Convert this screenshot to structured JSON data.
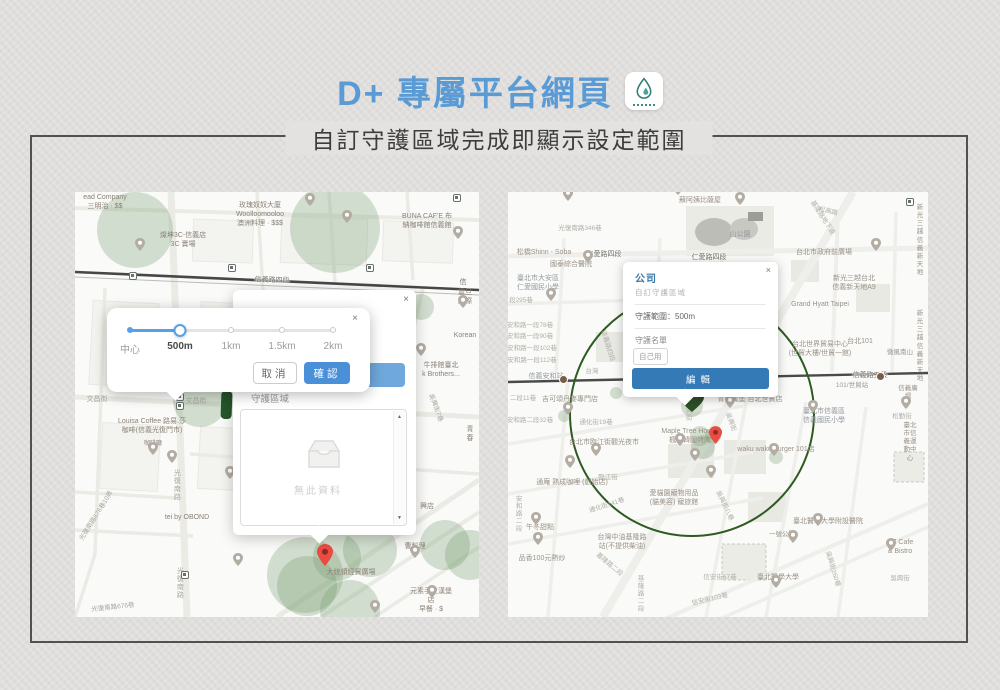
{
  "header": {
    "title": "D+ 專屬平台網頁",
    "subtitle": "自訂守護區域完成即顯示設定範圍"
  },
  "colors": {
    "title_blue": "#5b9bd5",
    "confirm_blue": "#4a90d9",
    "edit_blue": "#337ab7",
    "range_circle_green": "#2d5c20",
    "marker_green": "#26562b",
    "pin_red": "#ea4b42"
  },
  "left_map": {
    "slider_popup": {
      "close": "×",
      "ticks": [
        {
          "label": "中心",
          "x": 23
        },
        {
          "label": "500m",
          "x": 73,
          "selected": true
        },
        {
          "label": "1km",
          "x": 124
        },
        {
          "label": "1.5km",
          "x": 175
        },
        {
          "label": "2km",
          "x": 226
        }
      ],
      "cancel": "取消",
      "confirm": "確認"
    },
    "list_popup": {
      "close": "×",
      "section_label": "守護區域",
      "empty_text": "無此資料",
      "scroll_up": "▲",
      "scroll_down": "▼"
    },
    "labels": [
      {
        "t": "ead Company\n三明治 · $$",
        "x": 30,
        "y": 2,
        "c": "p"
      },
      {
        "t": "玫瑰奴奴大廈\nWoolloomooloo\n澳洲料理 · $$$",
        "x": 185,
        "y": 10,
        "c": "p"
      },
      {
        "t": "燦坤3C-信義店\n3C 賣場",
        "x": 108,
        "y": 40,
        "c": "p"
      },
      {
        "t": "BUNA CAF'E 布\n納咖啡館信義館",
        "x": 352,
        "y": 21,
        "c": "p"
      },
      {
        "t": "信義路四段",
        "x": 197,
        "y": 85,
        "c": "r",
        "r": 2
      },
      {
        "t": "信",
        "x": 388,
        "y": 87,
        "c": "r"
      },
      {
        "t": "震旦國際",
        "x": 390,
        "y": 97,
        "c": "p"
      },
      {
        "t": "Korean",
        "x": 390,
        "y": 140,
        "c": "p"
      },
      {
        "t": "牛排館臺北\nk Brothers...",
        "x": 366,
        "y": 170,
        "c": "p"
      },
      {
        "t": "吳興街7巷",
        "x": 360,
        "y": 212,
        "c": "g",
        "r": 70,
        "s": 6.5
      },
      {
        "t": "青春",
        "x": 395,
        "y": 234,
        "c": "p"
      },
      {
        "t": "文昌街",
        "x": 22,
        "y": 204,
        "c": "g"
      },
      {
        "t": "文昌街",
        "x": 121,
        "y": 206,
        "c": "g"
      },
      {
        "t": "Louisa Coffee 路易.莎\n咖啡(信義光復門市)",
        "x": 77,
        "y": 226,
        "c": "p"
      },
      {
        "t": "咖啡廳",
        "x": 78,
        "y": 249,
        "c": "p",
        "s": 6
      },
      {
        "t": "光復南路",
        "x": 101,
        "y": 277,
        "c": "g",
        "v": 1
      },
      {
        "t": "光復南路",
        "x": 104,
        "y": 375,
        "c": "g",
        "v": 1
      },
      {
        "t": "tei by OBOND",
        "x": 112,
        "y": 322,
        "c": "p"
      },
      {
        "t": "光復南路676巷10弄",
        "x": 22,
        "y": 320,
        "c": "g",
        "r": -58,
        "s": 6.5
      },
      {
        "t": "光復南路676巷",
        "x": 38,
        "y": 412,
        "c": "g",
        "r": -6,
        "s": 6.5
      },
      {
        "t": "大統領經貿廣場",
        "x": 276,
        "y": 377,
        "c": "p"
      },
      {
        "t": "曹料理",
        "x": 340,
        "y": 351,
        "c": "p"
      },
      {
        "t": "元素手工漢堡店\n早餐 · $",
        "x": 356,
        "y": 396,
        "c": "p"
      },
      {
        "t": "興店",
        "x": 352,
        "y": 311,
        "c": "p"
      }
    ],
    "circles": [
      [
        60,
        38,
        38
      ],
      [
        260,
        36,
        45
      ],
      [
        125,
        208,
        27
      ],
      [
        346,
        115,
        13
      ],
      [
        230,
        383,
        38
      ],
      [
        232,
        394,
        30
      ],
      [
        262,
        365,
        24
      ],
      [
        295,
        358,
        27
      ],
      [
        275,
        418,
        30
      ],
      [
        370,
        353,
        25
      ],
      [
        395,
        363,
        25
      ]
    ],
    "pins": [
      [
        235,
        13
      ],
      [
        272,
        30
      ],
      [
        383,
        46
      ],
      [
        65,
        58
      ],
      [
        78,
        262
      ],
      [
        97,
        270
      ],
      [
        155,
        286
      ],
      [
        163,
        373
      ],
      [
        340,
        365
      ],
      [
        357,
        405
      ],
      [
        300,
        420
      ],
      [
        346,
        163
      ],
      [
        388,
        115
      ]
    ],
    "squares": [
      [
        58,
        84
      ],
      [
        157,
        76
      ],
      [
        295,
        76
      ],
      [
        382,
        6
      ],
      [
        105,
        205
      ],
      [
        105,
        214
      ],
      [
        110,
        383
      ]
    ]
  },
  "right_map": {
    "info_popup": {
      "close": "×",
      "title": "公司",
      "subtitle": "自訂守護區域",
      "range": "守護範圍：500m",
      "list_label": "守護名單",
      "tag": "自己用",
      "edit": "編輯"
    },
    "range_circle": {
      "cx": 184,
      "cy": 222,
      "r": 122
    },
    "labels": [
      {
        "t": "蘇阿姨比薩屋",
        "x": 192,
        "y": 5,
        "c": "p"
      },
      {
        "t": "光復南路346巷",
        "x": 72,
        "y": 33,
        "c": "g",
        "s": 6.5
      },
      {
        "t": "山公園",
        "x": 232,
        "y": 39,
        "c": "b"
      },
      {
        "t": "松高路",
        "x": 320,
        "y": 16,
        "c": "g",
        "r": 14,
        "s": 6.5
      },
      {
        "t": "基隆路地下道",
        "x": 314,
        "y": 22,
        "c": "g",
        "r": 57,
        "s": 6.5
      },
      {
        "t": "新光三越\n信義新天地",
        "x": 412,
        "y": 12,
        "c": "p",
        "s": 6.5
      },
      {
        "t": "仁愛路四段",
        "x": 96,
        "y": 59,
        "c": "r"
      },
      {
        "t": "仁愛路四段",
        "x": 201,
        "y": 62,
        "c": "r"
      },
      {
        "t": "台北市政府前廣場",
        "x": 316,
        "y": 57,
        "c": "p"
      },
      {
        "t": "松橋Shinn - Soba",
        "x": 36,
        "y": 57,
        "c": "p"
      },
      {
        "t": "國泰綜合醫院",
        "x": 63,
        "y": 69,
        "c": "p"
      },
      {
        "t": "臺北市大安區\n仁愛國民小學",
        "x": 30,
        "y": 83,
        "c": "b"
      },
      {
        "t": "新光三越台北\n信義新天地A9",
        "x": 346,
        "y": 83,
        "c": "p"
      },
      {
        "t": "Grand Hyatt Taipei",
        "x": 312,
        "y": 109,
        "c": "p"
      },
      {
        "t": "新光三越\n信義新天地",
        "x": 412,
        "y": 118,
        "c": "p",
        "s": 6.5
      },
      {
        "t": "段295巷",
        "x": 13,
        "y": 105,
        "c": "g",
        "s": 6.5
      },
      {
        "t": "安和路一段78巷",
        "x": 22,
        "y": 130,
        "c": "g",
        "s": 6.5
      },
      {
        "t": "安和路一段90巷",
        "x": 22,
        "y": 141,
        "c": "g",
        "s": 6.5
      },
      {
        "t": "安和路一段102巷",
        "x": 24,
        "y": 153,
        "c": "g",
        "s": 6.5
      },
      {
        "t": "安和路一段112巷",
        "x": 24,
        "y": 165,
        "c": "g",
        "s": 6.5
      },
      {
        "t": "信義路四段",
        "x": 99,
        "y": 150,
        "c": "g",
        "r": 73,
        "s": 6.5
      },
      {
        "t": "台北世界貿易中心\n(世貿大樓/世貿一館)",
        "x": 312,
        "y": 149,
        "c": "p"
      },
      {
        "t": "台北101",
        "x": 352,
        "y": 146,
        "c": "p"
      },
      {
        "t": "微風南山",
        "x": 392,
        "y": 157,
        "c": "p",
        "s": 6.5
      },
      {
        "t": "信義安和站",
        "x": 38,
        "y": 181,
        "c": "b"
      },
      {
        "t": "台灣",
        "x": 84,
        "y": 176,
        "c": "g",
        "s": 6.5
      },
      {
        "t": "信義路五段",
        "x": 362,
        "y": 180,
        "c": "r"
      },
      {
        "t": "101/世貿站",
        "x": 344,
        "y": 190,
        "c": "b",
        "s": 6.5
      },
      {
        "t": "信義廣場",
        "x": 400,
        "y": 193,
        "c": "p",
        "s": 6.5
      },
      {
        "t": "二段11巷",
        "x": 15,
        "y": 203,
        "c": "g",
        "s": 6.5
      },
      {
        "t": "吉可頌丹麥專門店",
        "x": 62,
        "y": 204,
        "c": "p"
      },
      {
        "t": "青春漢堡 台北世貿店",
        "x": 242,
        "y": 204,
        "c": "p"
      },
      {
        "t": "臺北市信義區\n信義國民小學",
        "x": 316,
        "y": 216,
        "c": "b"
      },
      {
        "t": "松勤街",
        "x": 394,
        "y": 221,
        "c": "g",
        "s": 6.5
      },
      {
        "t": "臺北市信義運動中心",
        "x": 402,
        "y": 230,
        "c": "p",
        "s": 6.5
      },
      {
        "t": "安和路二段32巷",
        "x": 22,
        "y": 225,
        "c": "g",
        "s": 6.5
      },
      {
        "t": "通化街19巷",
        "x": 88,
        "y": 227,
        "c": "g",
        "s": 6.5
      },
      {
        "t": "Maple Tree House\n楓樹韓國烤肉",
        "x": 182,
        "y": 236,
        "c": "p"
      },
      {
        "t": "吳興街",
        "x": 222,
        "y": 226,
        "c": "g",
        "r": 70,
        "s": 6.5
      },
      {
        "t": "waku waku burger 101店",
        "x": 268,
        "y": 254,
        "c": "p"
      },
      {
        "t": "台北市臨江街觀光夜市",
        "x": 96,
        "y": 247,
        "c": "p"
      },
      {
        "t": "臨江街",
        "x": 100,
        "y": 282,
        "c": "g",
        "s": 6.5
      },
      {
        "t": "通庵 熟成咖哩 (創始店)",
        "x": 64,
        "y": 287,
        "c": "p"
      },
      {
        "t": "愛貓園寵物用品\n(貓美容) 寵旅館",
        "x": 166,
        "y": 298,
        "c": "p"
      },
      {
        "t": "吳興街八巷",
        "x": 216,
        "y": 310,
        "c": "g",
        "r": 64,
        "s": 6.5
      },
      {
        "t": "午冬甜點",
        "x": 32,
        "y": 332,
        "c": "p"
      },
      {
        "t": "通化街141巷",
        "x": 99,
        "y": 310,
        "c": "g",
        "r": -18,
        "s": 6.5
      },
      {
        "t": "安和路二段",
        "x": 9,
        "y": 303,
        "c": "g",
        "v": 1,
        "s": 6.5
      },
      {
        "t": "基隆路二段",
        "x": 101,
        "y": 369,
        "c": "g",
        "r": 40,
        "s": 6.5
      },
      {
        "t": "台灣中油基隆路\n站(不提供柴油)",
        "x": 114,
        "y": 342,
        "c": "p"
      },
      {
        "t": "品香100元熱炒",
        "x": 34,
        "y": 363,
        "c": "p"
      },
      {
        "t": "臺北醫學大學附設醫院",
        "x": 320,
        "y": 326,
        "c": "p"
      },
      {
        "t": "一號公園",
        "x": 274,
        "y": 339,
        "c": "p",
        "s": 6.5
      },
      {
        "t": "OZ Cafe & Bistro",
        "x": 392,
        "y": 347,
        "c": "p"
      },
      {
        "t": "信安街67巷",
        "x": 212,
        "y": 382,
        "c": "g",
        "s": 6.5
      },
      {
        "t": "臺北醫學大學",
        "x": 270,
        "y": 382,
        "c": "p"
      },
      {
        "t": "吳興街260巷",
        "x": 324,
        "y": 373,
        "c": "g",
        "r": 73,
        "s": 6.5
      },
      {
        "t": "吳興街",
        "x": 392,
        "y": 383,
        "c": "g",
        "s": 6.5
      },
      {
        "t": "信安街103巷",
        "x": 202,
        "y": 404,
        "c": "g",
        "r": -13,
        "s": 6.5
      },
      {
        "t": "基隆路二段",
        "x": 131,
        "y": 383,
        "c": "g",
        "v": 1,
        "s": 6.5
      },
      {
        "t": "吳興街",
        "x": 179,
        "y": 207,
        "c": "g",
        "v": 1,
        "s": 6.5
      }
    ],
    "circles": [
      [
        195,
        255,
        12
      ],
      [
        205,
        244,
        8
      ],
      [
        268,
        265,
        7
      ],
      [
        56,
        224,
        6
      ],
      [
        108,
        201,
        6
      ],
      [
        184,
        214,
        11
      ],
      [
        192,
        244,
        10
      ]
    ],
    "pins": [
      [
        60,
        8
      ],
      [
        170,
        2
      ],
      [
        232,
        12
      ],
      [
        368,
        58
      ],
      [
        80,
        70
      ],
      [
        43,
        108
      ],
      [
        60,
        222
      ],
      [
        222,
        215
      ],
      [
        305,
        220
      ],
      [
        398,
        216
      ],
      [
        62,
        275
      ],
      [
        88,
        263
      ],
      [
        172,
        253
      ],
      [
        187,
        268
      ],
      [
        203,
        285
      ],
      [
        266,
        263
      ],
      [
        28,
        332
      ],
      [
        30,
        352
      ],
      [
        285,
        350
      ],
      [
        383,
        358
      ],
      [
        268,
        395
      ],
      [
        310,
        333
      ]
    ],
    "squares": [
      [
        402,
        10
      ]
    ],
    "metro": [
      [
        55,
        187
      ],
      [
        372,
        184
      ]
    ]
  }
}
